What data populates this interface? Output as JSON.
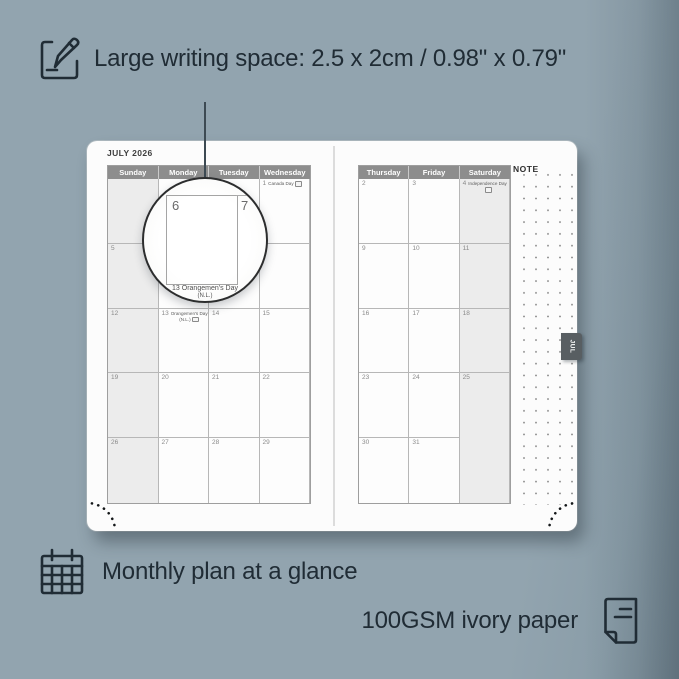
{
  "annotations": {
    "top": {
      "text": "Large writing space: 2.5 x 2cm / 0.98\" x 0.79\""
    },
    "bottom_left": {
      "text": "Monthly plan at a glance"
    },
    "bottom_right": {
      "text": "100GSM ivory paper"
    }
  },
  "planner": {
    "month_title": "JULY 2026",
    "tab_label": "JUL",
    "note_label": "NOTE",
    "left_page": {
      "day_headers": [
        "Sunday",
        "Monday",
        "Tuesday",
        "Wednesday"
      ],
      "weekend_cols": [
        0
      ],
      "weeks": [
        [
          {
            "d": ""
          },
          {
            "d": ""
          },
          {
            "d": ""
          },
          {
            "d": "1",
            "holiday": "Canada Day",
            "flag_inline": true
          }
        ],
        [
          {
            "d": "5"
          },
          {
            "d": "6"
          },
          {
            "d": "7"
          },
          {
            "d": "8"
          }
        ],
        [
          {
            "d": "12"
          },
          {
            "d": "13",
            "holiday": "Orangemen's Day",
            "sub": "(N.L.)"
          },
          {
            "d": "14"
          },
          {
            "d": "15"
          }
        ],
        [
          {
            "d": "19"
          },
          {
            "d": "20"
          },
          {
            "d": "21"
          },
          {
            "d": "22"
          }
        ],
        [
          {
            "d": "26"
          },
          {
            "d": "27"
          },
          {
            "d": "28"
          },
          {
            "d": "29"
          }
        ]
      ]
    },
    "right_page": {
      "day_headers": [
        "Thursday",
        "Friday",
        "Saturday"
      ],
      "weekend_cols": [
        2
      ],
      "weeks": [
        [
          {
            "d": "2"
          },
          {
            "d": "3"
          },
          {
            "d": "4",
            "holiday": "Independence Day",
            "sub": ""
          }
        ],
        [
          {
            "d": "9"
          },
          {
            "d": "10"
          },
          {
            "d": "11"
          }
        ],
        [
          {
            "d": "16"
          },
          {
            "d": "17"
          },
          {
            "d": "18"
          }
        ],
        [
          {
            "d": "23"
          },
          {
            "d": "24"
          },
          {
            "d": "25"
          }
        ],
        [
          {
            "d": "30"
          },
          {
            "d": "31"
          },
          {
            "d": ""
          }
        ]
      ]
    }
  },
  "magnifier": {
    "day_left": "6",
    "day_right": "7",
    "caption_line1": "13  Orangemen's Day",
    "caption_line2": "(N.L.)"
  },
  "colors": {
    "background": "#92a4af",
    "page": "#fcfcfc",
    "header_bar": "#8d8d8d",
    "weekend_fill": "#ececec",
    "tab": "#585e62",
    "annotation_text": "#202c35"
  }
}
